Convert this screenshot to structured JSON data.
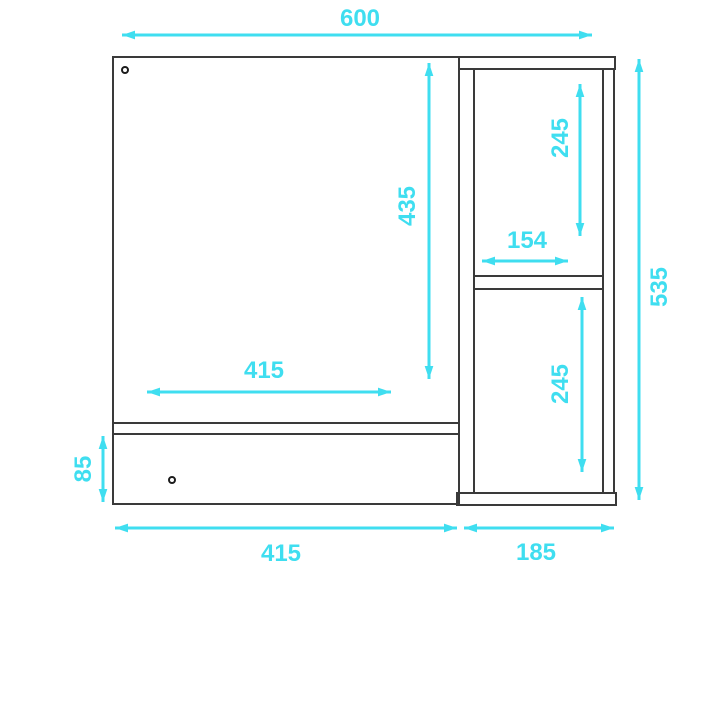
{
  "colors": {
    "dimension_accent": "#3fdef0",
    "drawing_line": "#3a3a3a"
  },
  "dimensions": {
    "overall_width": "600",
    "overall_height": "535",
    "door_height": "435",
    "door_width": "415",
    "cabinet_bottom_width": "415",
    "drawer_height": "85",
    "side_unit_width": "185",
    "side_opening_width": "154",
    "side_opening_top_height": "245",
    "side_opening_bottom_height": "245"
  }
}
